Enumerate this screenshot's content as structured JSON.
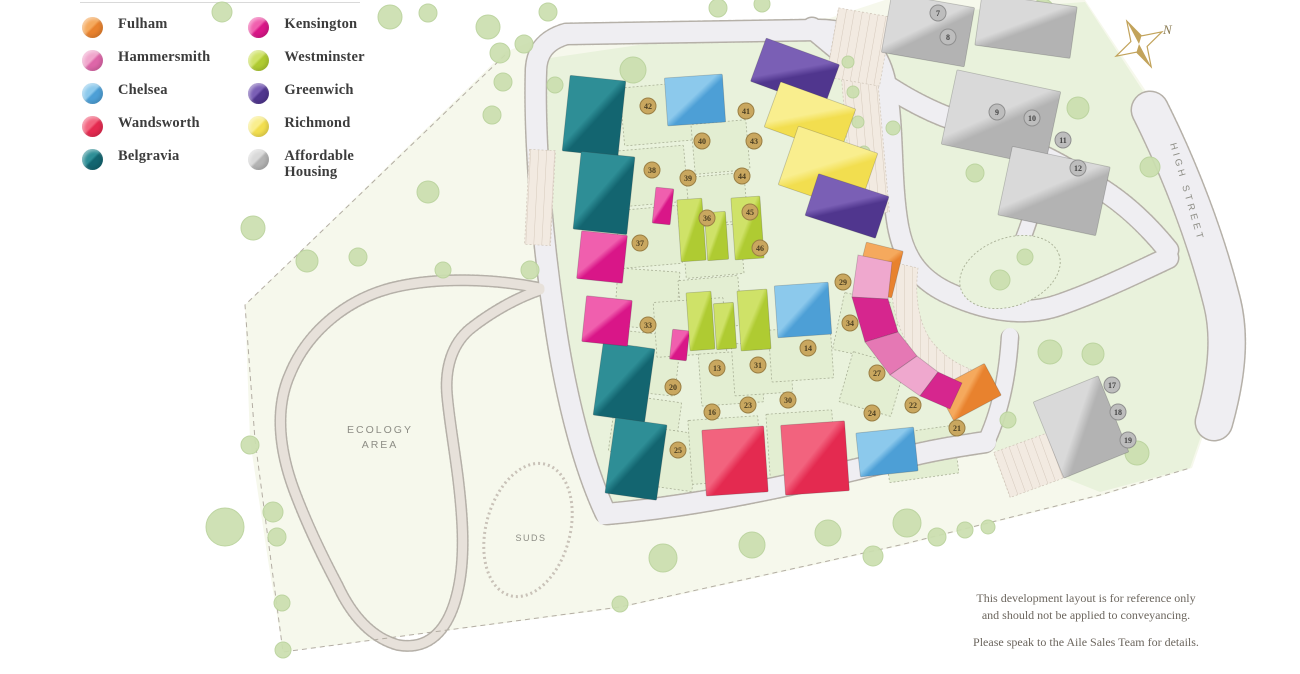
{
  "legend": {
    "items": [
      {
        "id": "fulham",
        "label": "Fulham",
        "light": "#F5A95D",
        "dark": "#E8822E"
      },
      {
        "id": "hammersmith",
        "label": "Hammersmith",
        "light": "#F0A6CC",
        "dark": "#DD66A8"
      },
      {
        "id": "chelsea",
        "label": "Chelsea",
        "light": "#8CC9EC",
        "dark": "#4D9FD6"
      },
      {
        "id": "wandsworth",
        "label": "Wandsworth",
        "light": "#F2637E",
        "dark": "#E42A50"
      },
      {
        "id": "belgravia",
        "label": "Belgravia",
        "light": "#2E8E96",
        "dark": "#136570"
      },
      {
        "id": "kensington",
        "label": "Kensington",
        "light": "#F05FAE",
        "dark": "#D91688"
      },
      {
        "id": "westminster",
        "label": "Westminster",
        "light": "#CFE268",
        "dark": "#AFCB32"
      },
      {
        "id": "greenwich",
        "label": "Greenwich",
        "light": "#7A5FB5",
        "dark": "#50368E"
      },
      {
        "id": "richmond",
        "label": "Richmond",
        "light": "#F9EE8E",
        "dark": "#F2DE4F"
      },
      {
        "id": "affordable",
        "label": "Affordable Housing",
        "light": "#D9D9D9",
        "dark": "#B3B3B3"
      }
    ]
  },
  "map": {
    "labels": {
      "ecology_line1": "ECOLOGY",
      "ecology_line2": "AREA",
      "suds": "SUDS",
      "street": "HIGH STREET",
      "compass": "N"
    },
    "disclaimer": [
      "This development layout is for reference only",
      "and should not be applied to conveyancing.",
      "Please speak to the Aile Sales Team for details."
    ],
    "site": {
      "outer": "505,52 566,28 830,18 885,0 1085,0 1160,112 1238,298 1232,352 1192,468 1100,496 900,546 620,608 283,652 268,560 250,440 245,305",
      "dev": "536,60 700,36 830,20 1085,2 1158,114 1236,300 1230,352 1190,468 1100,492 985,446 780,496 608,518 572,420 548,260 536,120",
      "boundary": "505,55 245,305 255,440 283,652 620,607 900,545 1100,495 1190,468"
    },
    "roads": [
      {
        "d": "M 536,72 C 536,52 546,40 566,34 L 818,30",
        "w": 20,
        "k": "road"
      },
      {
        "d": "M 818,30 C 862,30 880,52 886,86 C 894,132 890,180 898,226 C 904,258 918,278 946,292 C 984,310 1024,318 1062,304 C 1096,292 1130,276 1168,258",
        "w": 20,
        "k": "road"
      },
      {
        "d": "M 536,70 C 534,140 542,240 556,330 C 568,408 586,472 606,514 C 700,506 800,484 902,458 C 932,450 960,446 986,442",
        "w": 20,
        "k": "road"
      },
      {
        "d": "M 986,442 C 1002,408 1008,370 1010,336",
        "w": 16,
        "k": "road"
      },
      {
        "d": "M 812,28 C 852,62 894,96 944,116 C 994,134 1042,152 1082,178 C 1114,194 1142,218 1168,250",
        "w": 20,
        "k": "road"
      },
      {
        "d": "M 1046,158 C 1038,198 1028,228 1016,256",
        "w": 14,
        "k": "road"
      },
      {
        "d": "M 1150,110 C 1180,170 1206,238 1222,302 C 1230,334 1228,372 1214,422",
        "w": 36,
        "k": "road"
      },
      {
        "d": "M 540,288 C 490,278 438,278 400,286 C 350,296 308,330 290,374 C 274,410 280,452 294,490 C 306,522 320,552 338,586 C 352,616 372,638 398,645 C 426,650 446,634 456,598 C 466,562 463,520 458,478 C 454,446 449,418 447,394 C 445,368 452,344 470,329 C 490,313 516,298 540,290",
        "w": 9,
        "k": "path"
      }
    ],
    "island": {
      "cx": 1010,
      "cy": 272,
      "rx": 52,
      "ry": 34,
      "rot": -20
    },
    "suds_oval": {
      "cx": 528,
      "cy": 530,
      "rx": 42,
      "ry": 68,
      "rot": 15
    },
    "parking": [
      {
        "x": 846,
        "y": 44,
        "w": 36,
        "h": 170,
        "r": -5
      },
      {
        "x": 832,
        "y": 12,
        "w": 54,
        "h": 70,
        "r": 10
      },
      {
        "x": 527,
        "y": 150,
        "w": 26,
        "h": 95,
        "r": 3
      },
      {
        "x": 1000,
        "y": 440,
        "w": 64,
        "h": 48,
        "r": -20
      }
    ],
    "arc_parking": "M892,262 C888,300 898,335 917,357 C932,373 947,380 962,383 L978,372 C960,366 945,357 934,344 C920,328 914,300 918,268 Z",
    "parcels": [
      {
        "x": 622,
        "y": 85,
        "w": 70,
        "h": 58,
        "r": -5
      },
      {
        "x": 620,
        "y": 148,
        "w": 66,
        "h": 56,
        "r": -5
      },
      {
        "x": 618,
        "y": 208,
        "w": 62,
        "h": 58,
        "r": -5
      },
      {
        "x": 616,
        "y": 270,
        "w": 62,
        "h": 58,
        "r": 4
      },
      {
        "x": 614,
        "y": 333,
        "w": 64,
        "h": 60,
        "r": 6
      },
      {
        "x": 612,
        "y": 398,
        "w": 66,
        "h": 58,
        "r": 8
      },
      {
        "x": 693,
        "y": 122,
        "w": 55,
        "h": 50,
        "r": -5
      },
      {
        "x": 688,
        "y": 175,
        "w": 58,
        "h": 48,
        "r": -5
      },
      {
        "x": 684,
        "y": 226,
        "w": 58,
        "h": 50,
        "r": -5
      },
      {
        "x": 680,
        "y": 278,
        "w": 60,
        "h": 50,
        "r": -5
      },
      {
        "x": 655,
        "y": 300,
        "w": 70,
        "h": 55,
        "r": -4
      },
      {
        "x": 700,
        "y": 352,
        "w": 62,
        "h": 52,
        "r": -4
      },
      {
        "x": 733,
        "y": 342,
        "w": 58,
        "h": 52,
        "r": -4
      },
      {
        "x": 770,
        "y": 328,
        "w": 62,
        "h": 52,
        "r": -4
      },
      {
        "x": 640,
        "y": 430,
        "w": 56,
        "h": 58,
        "r": 8
      },
      {
        "x": 690,
        "y": 418,
        "w": 70,
        "h": 64,
        "r": -4
      },
      {
        "x": 768,
        "y": 412,
        "w": 66,
        "h": 64,
        "r": -4
      },
      {
        "x": 838,
        "y": 298,
        "w": 58,
        "h": 58,
        "r": 12
      },
      {
        "x": 845,
        "y": 358,
        "w": 54,
        "h": 52,
        "r": 16
      },
      {
        "x": 886,
        "y": 430,
        "w": 70,
        "h": 48,
        "r": -8
      }
    ],
    "buildings": [
      {
        "t": "belgravia",
        "x": 566,
        "y": 78,
        "w": 56,
        "h": 76,
        "r": 6
      },
      {
        "t": "belgravia",
        "x": 577,
        "y": 154,
        "w": 54,
        "h": 78,
        "r": 6
      },
      {
        "t": "belgravia",
        "x": 598,
        "y": 345,
        "w": 52,
        "h": 74,
        "r": 8
      },
      {
        "t": "belgravia",
        "x": 610,
        "y": 421,
        "w": 52,
        "h": 76,
        "r": 8
      },
      {
        "t": "kensington",
        "x": 579,
        "y": 233,
        "w": 46,
        "h": 48,
        "r": 6
      },
      {
        "t": "kensington",
        "x": 584,
        "y": 298,
        "w": 46,
        "h": 46,
        "r": 6
      },
      {
        "t": "kensington",
        "x": 654,
        "y": 188,
        "w": 18,
        "h": 36,
        "r": 6
      },
      {
        "t": "kensington",
        "x": 671,
        "y": 330,
        "w": 17,
        "h": 30,
        "r": 6
      },
      {
        "t": "chelsea",
        "x": 666,
        "y": 76,
        "w": 58,
        "h": 48,
        "r": -4
      },
      {
        "t": "chelsea",
        "x": 776,
        "y": 284,
        "w": 54,
        "h": 52,
        "r": -4
      },
      {
        "t": "chelsea",
        "x": 858,
        "y": 430,
        "w": 58,
        "h": 44,
        "r": -6
      },
      {
        "t": "westminster",
        "x": 679,
        "y": 199,
        "w": 25,
        "h": 62,
        "r": -4
      },
      {
        "t": "westminster",
        "x": 706,
        "y": 212,
        "w": 21,
        "h": 48,
        "r": -4
      },
      {
        "t": "westminster",
        "x": 733,
        "y": 197,
        "w": 29,
        "h": 62,
        "r": -4
      },
      {
        "t": "westminster",
        "x": 688,
        "y": 292,
        "w": 25,
        "h": 58,
        "r": -4
      },
      {
        "t": "westminster",
        "x": 715,
        "y": 303,
        "w": 20,
        "h": 46,
        "r": -4
      },
      {
        "t": "westminster",
        "x": 739,
        "y": 290,
        "w": 30,
        "h": 60,
        "r": -4
      },
      {
        "t": "greenwich",
        "x": 756,
        "y": 50,
        "w": 78,
        "h": 46,
        "r": 20
      },
      {
        "t": "richmond",
        "x": 770,
        "y": 94,
        "w": 80,
        "h": 48,
        "r": 20
      },
      {
        "t": "richmond",
        "x": 786,
        "y": 138,
        "w": 84,
        "h": 62,
        "r": 19
      },
      {
        "t": "greenwich",
        "x": 810,
        "y": 184,
        "w": 74,
        "h": 44,
        "r": 18
      },
      {
        "t": "wandsworth",
        "x": 704,
        "y": 428,
        "w": 62,
        "h": 66,
        "r": -4
      },
      {
        "t": "wandsworth",
        "x": 783,
        "y": 423,
        "w": 64,
        "h": 70,
        "r": -4
      },
      {
        "t": "fulham",
        "x": 860,
        "y": 246,
        "w": 38,
        "h": 48,
        "r": 14
      },
      {
        "t": "fulham",
        "x": 942,
        "y": 374,
        "w": 54,
        "h": 36,
        "r": -28
      },
      {
        "t": "affordable",
        "x": 886,
        "y": 0,
        "w": 84,
        "h": 60,
        "r": 10
      },
      {
        "t": "affordable",
        "x": 978,
        "y": 0,
        "w": 96,
        "h": 52,
        "r": 8
      },
      {
        "t": "affordable",
        "x": 948,
        "y": 80,
        "w": 106,
        "h": 76,
        "r": 12
      },
      {
        "t": "affordable",
        "x": 1004,
        "y": 156,
        "w": 100,
        "h": 70,
        "r": 12
      },
      {
        "t": "affordable",
        "x": 1046,
        "y": 386,
        "w": 70,
        "h": 82,
        "r": -22
      }
    ],
    "arc": [
      {
        "pts": "858,255 892,262 888,299 852,297",
        "fill": "#EFA8CE"
      },
      {
        "pts": "852,297 888,299 898,332 865,342",
        "fill": "#D6268E"
      },
      {
        "pts": "865,342 898,332 917,356 890,375",
        "fill": "#E578B4"
      },
      {
        "pts": "890,375 917,356 938,372 920,396",
        "fill": "#EFA8CE"
      },
      {
        "pts": "920,396 938,372 962,383 950,409",
        "fill": "#D6268E"
      }
    ],
    "trees": [
      {
        "x": 222,
        "y": 12,
        "r": 10
      },
      {
        "x": 390,
        "y": 17,
        "r": 12
      },
      {
        "x": 428,
        "y": 13,
        "r": 9
      },
      {
        "x": 488,
        "y": 27,
        "r": 12
      },
      {
        "x": 524,
        "y": 44,
        "r": 9
      },
      {
        "x": 548,
        "y": 12,
        "r": 9
      },
      {
        "x": 718,
        "y": 8,
        "r": 9
      },
      {
        "x": 762,
        "y": 4,
        "r": 8
      },
      {
        "x": 633,
        "y": 70,
        "r": 13
      },
      {
        "x": 500,
        "y": 53,
        "r": 10
      },
      {
        "x": 503,
        "y": 82,
        "r": 9
      },
      {
        "x": 492,
        "y": 115,
        "r": 9
      },
      {
        "x": 428,
        "y": 192,
        "r": 11
      },
      {
        "x": 358,
        "y": 257,
        "r": 9
      },
      {
        "x": 443,
        "y": 270,
        "r": 8
      },
      {
        "x": 530,
        "y": 270,
        "r": 9
      },
      {
        "x": 555,
        "y": 85,
        "r": 8
      },
      {
        "x": 253,
        "y": 228,
        "r": 12
      },
      {
        "x": 307,
        "y": 261,
        "r": 11
      },
      {
        "x": 225,
        "y": 527,
        "r": 19
      },
      {
        "x": 273,
        "y": 512,
        "r": 10
      },
      {
        "x": 277,
        "y": 537,
        "r": 9
      },
      {
        "x": 282,
        "y": 603,
        "r": 8
      },
      {
        "x": 283,
        "y": 650,
        "r": 8
      },
      {
        "x": 250,
        "y": 445,
        "r": 9
      },
      {
        "x": 663,
        "y": 558,
        "r": 14
      },
      {
        "x": 752,
        "y": 545,
        "r": 13
      },
      {
        "x": 828,
        "y": 533,
        "r": 13
      },
      {
        "x": 873,
        "y": 556,
        "r": 10
      },
      {
        "x": 907,
        "y": 523,
        "r": 14
      },
      {
        "x": 937,
        "y": 537,
        "r": 9
      },
      {
        "x": 965,
        "y": 530,
        "r": 8
      },
      {
        "x": 988,
        "y": 527,
        "r": 7
      },
      {
        "x": 620,
        "y": 604,
        "r": 8
      },
      {
        "x": 1050,
        "y": 352,
        "r": 12
      },
      {
        "x": 1093,
        "y": 354,
        "r": 11
      },
      {
        "x": 1137,
        "y": 453,
        "r": 12
      },
      {
        "x": 1150,
        "y": 167,
        "r": 10
      },
      {
        "x": 1078,
        "y": 108,
        "r": 11
      },
      {
        "x": 1043,
        "y": 10,
        "r": 11
      },
      {
        "x": 975,
        "y": 173,
        "r": 9
      },
      {
        "x": 1000,
        "y": 280,
        "r": 10
      },
      {
        "x": 1025,
        "y": 257,
        "r": 8
      },
      {
        "x": 848,
        "y": 62,
        "r": 6
      },
      {
        "x": 853,
        "y": 92,
        "r": 6
      },
      {
        "x": 858,
        "y": 122,
        "r": 6
      },
      {
        "x": 864,
        "y": 152,
        "r": 6
      },
      {
        "x": 893,
        "y": 128,
        "r": 7
      },
      {
        "x": 1008,
        "y": 420,
        "r": 8
      }
    ],
    "plots": [
      {
        "n": "42",
        "x": 648,
        "y": 106,
        "g": false
      },
      {
        "n": "41",
        "x": 746,
        "y": 111,
        "g": false
      },
      {
        "n": "40",
        "x": 702,
        "y": 141,
        "g": false
      },
      {
        "n": "43",
        "x": 754,
        "y": 141,
        "g": false
      },
      {
        "n": "39",
        "x": 688,
        "y": 178,
        "g": false
      },
      {
        "n": "44",
        "x": 742,
        "y": 176,
        "g": false
      },
      {
        "n": "38",
        "x": 652,
        "y": 170,
        "g": false
      },
      {
        "n": "45",
        "x": 750,
        "y": 212,
        "g": false
      },
      {
        "n": "46",
        "x": 760,
        "y": 248,
        "g": false
      },
      {
        "n": "37",
        "x": 640,
        "y": 243,
        "g": false
      },
      {
        "n": "36",
        "x": 707,
        "y": 218,
        "g": false
      },
      {
        "n": "34",
        "x": 850,
        "y": 323,
        "g": false
      },
      {
        "n": "29",
        "x": 843,
        "y": 282,
        "g": false
      },
      {
        "n": "14",
        "x": 808,
        "y": 348,
        "g": false
      },
      {
        "n": "31",
        "x": 758,
        "y": 365,
        "g": false
      },
      {
        "n": "13",
        "x": 717,
        "y": 368,
        "g": false
      },
      {
        "n": "20",
        "x": 673,
        "y": 387,
        "g": false
      },
      {
        "n": "16",
        "x": 712,
        "y": 412,
        "g": false
      },
      {
        "n": "23",
        "x": 748,
        "y": 405,
        "g": false
      },
      {
        "n": "30",
        "x": 788,
        "y": 400,
        "g": false
      },
      {
        "n": "27",
        "x": 877,
        "y": 373,
        "g": false
      },
      {
        "n": "24",
        "x": 872,
        "y": 413,
        "g": false
      },
      {
        "n": "22",
        "x": 913,
        "y": 405,
        "g": false
      },
      {
        "n": "25",
        "x": 678,
        "y": 450,
        "g": false
      },
      {
        "n": "21",
        "x": 957,
        "y": 428,
        "g": false
      },
      {
        "n": "33",
        "x": 648,
        "y": 325,
        "g": false
      },
      {
        "n": "17",
        "x": 1112,
        "y": 385,
        "g": true
      },
      {
        "n": "18",
        "x": 1118,
        "y": 412,
        "g": true
      },
      {
        "n": "19",
        "x": 1128,
        "y": 440,
        "g": true
      },
      {
        "n": "7",
        "x": 938,
        "y": 13,
        "g": true
      },
      {
        "n": "8",
        "x": 948,
        "y": 37,
        "g": true
      },
      {
        "n": "9",
        "x": 997,
        "y": 112,
        "g": true
      },
      {
        "n": "10",
        "x": 1032,
        "y": 118,
        "g": true
      },
      {
        "n": "11",
        "x": 1063,
        "y": 140,
        "g": true
      },
      {
        "n": "12",
        "x": 1078,
        "y": 168,
        "g": true
      }
    ],
    "colors": {
      "site_outer": "#F6F8EC",
      "site_dev": "#E9F2DC",
      "parcel": "#E3EED2",
      "road": "#EFEEF2",
      "path": "#E7E1DA",
      "casing": "#B5B0A8",
      "tree": "#CBDFAF",
      "tree_edge": "#B9D29B",
      "parking": "#F2EAE1",
      "parking_line": "#D5C9BC",
      "plot_gold": "#C9A75F",
      "plot_gold_ring": "#9A7F44",
      "plot_grey": "#BDBDBD",
      "plot_grey_ring": "#8F8F8F",
      "label": "#8D8D85",
      "compass": "#C2A35B"
    }
  }
}
